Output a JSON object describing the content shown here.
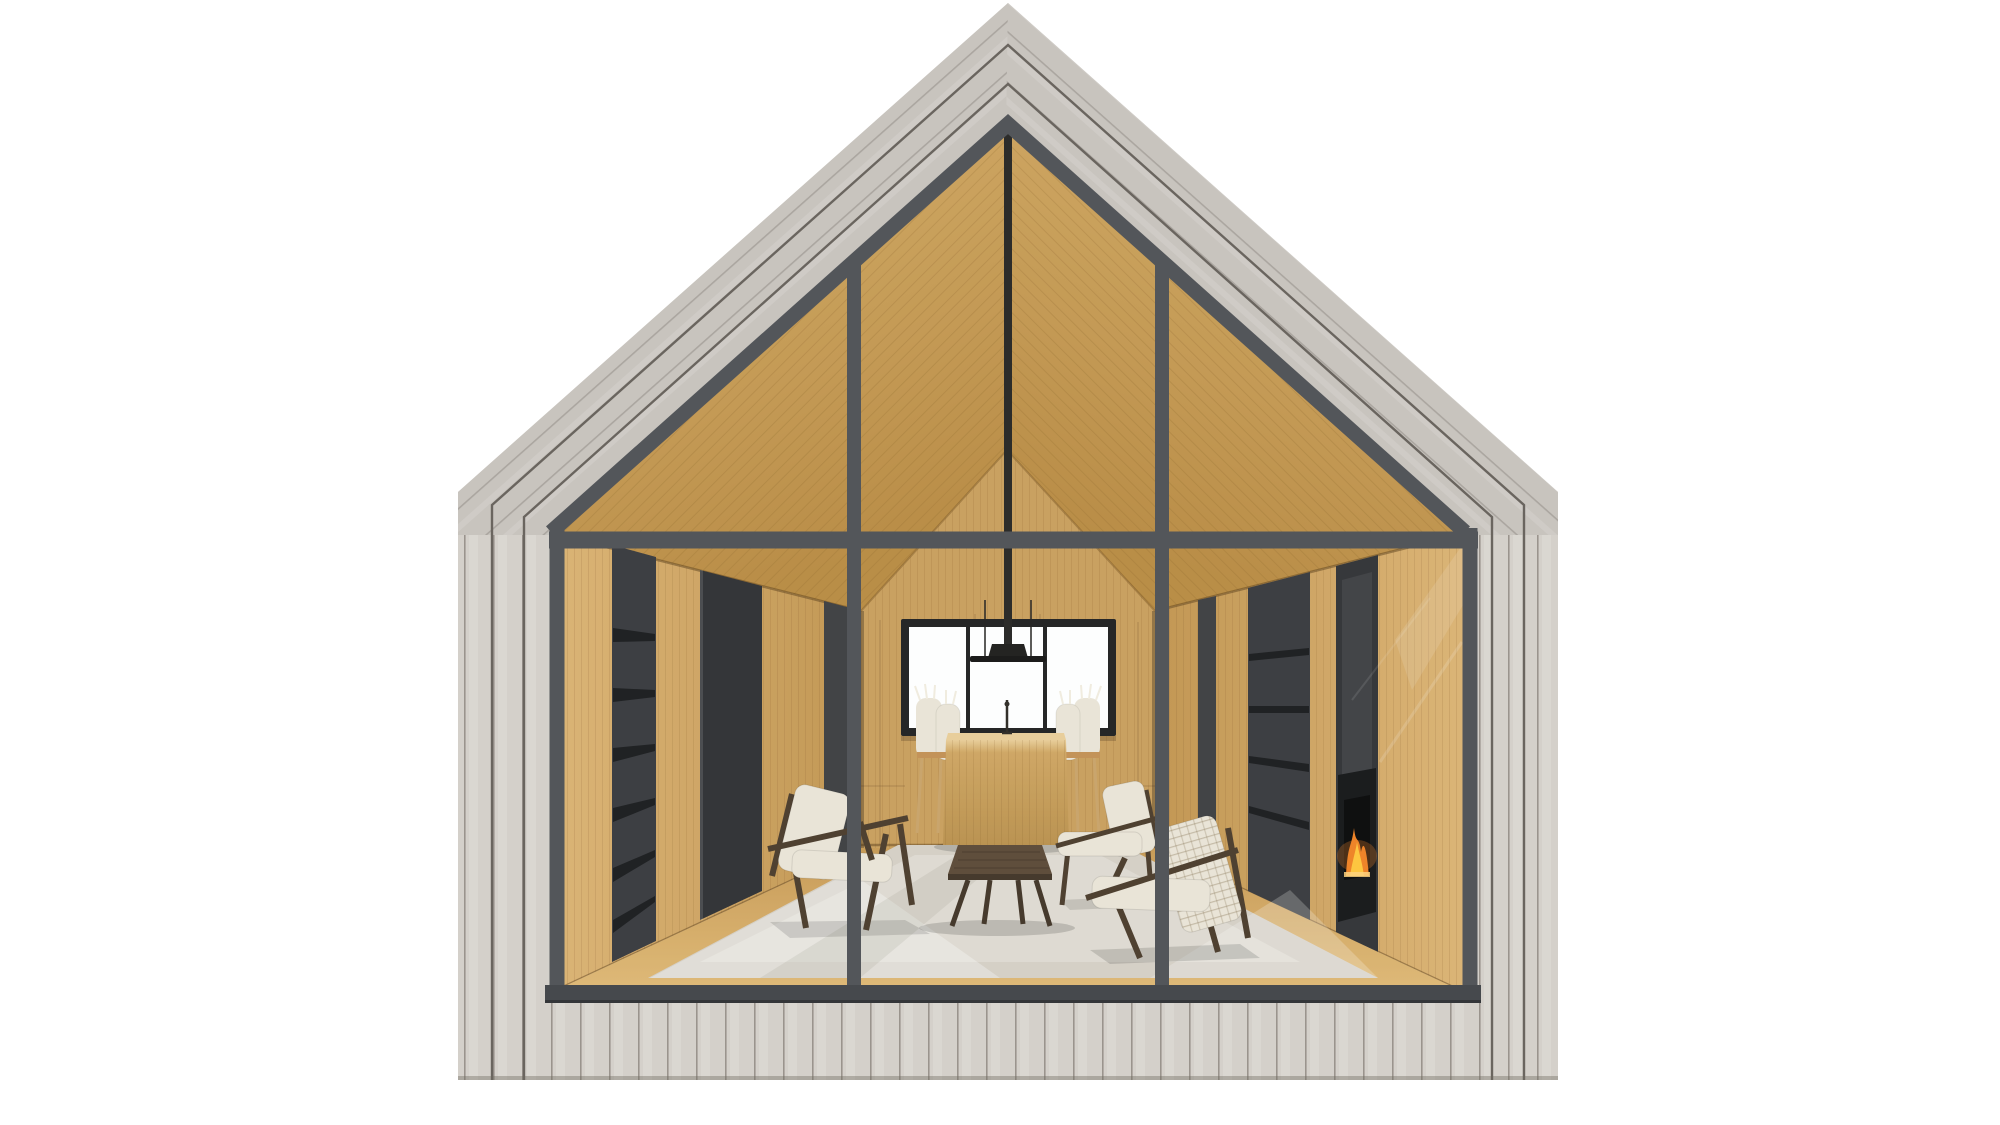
{
  "meta": {
    "render_type": "architectural elevation render",
    "subject": "gabled cabin with glazed gable facade, interior living room visible"
  },
  "palette": {
    "bg": "#ffffff",
    "cladding_light": "#d4d0ca",
    "cladding_mid": "#c8c4be",
    "roof_seam": "#6a655f",
    "plank_line": "#9d978f",
    "frame_slate": "#53565a",
    "frame_slate_dark": "#46494d",
    "oak_ceiling_hi": "#d6ac66",
    "oak_ceiling_lo": "#b8893f",
    "oak_wall_hi": "#dcb271",
    "oak_wall_lo": "#c1934d",
    "oak_wall_back": "#c99d5a",
    "oak_floor_hi": "#e0b873",
    "oak_floor_lo": "#c79851",
    "niche_dark": "#35363a",
    "shelf_black": "#17181a",
    "window_white": "#ffffff",
    "window_frame": "#1d1d1d",
    "pendant_black": "#232220",
    "table_oak_hi": "#e9cd97",
    "table_oak": "#cfa45f",
    "walnut": "#483828",
    "coffee_table_top": "#594633",
    "coffee_table_dark": "#3f3123",
    "cushion_cream": "#eae4d6",
    "chair_leg_wood": "#c9a267",
    "rug": "#d5cfc5",
    "rug_light": "#e8e3da",
    "fire_orange": "#f07f1f",
    "fire_yellow": "#ffc437",
    "ember": "#ffd27a"
  },
  "scene": {
    "exterior": [
      "grey-wood-roof-cladding",
      "grey-wood-wall-cladding"
    ],
    "facade": [
      "slate-glass-frame",
      "horizontal-mullion",
      "vertical-mullions",
      "bottom-sill"
    ],
    "interior": [
      "oak-ceiling",
      "oak-back-wall",
      "back-window",
      "left-bookshelf-wall",
      "right-wall-fireplace",
      "fire-flames",
      "oak-floor",
      "area-rug",
      "pendant-light",
      "dining-table",
      "dining-chairs",
      "candlestick",
      "lounge-chair-left",
      "lounge-chair-right-back",
      "lounge-chair-right-front",
      "coffee-table"
    ]
  }
}
